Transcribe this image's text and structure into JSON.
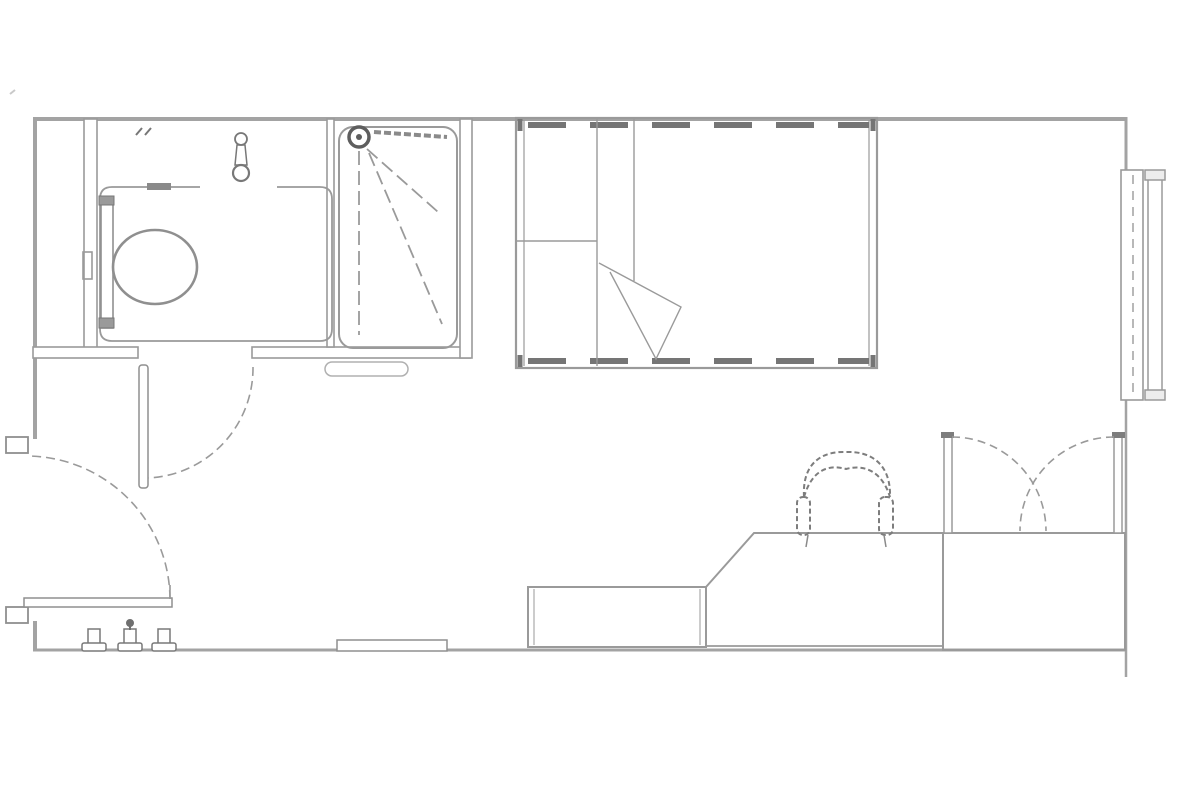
{
  "plan": {
    "type": "floor-plan",
    "background": "#ffffff",
    "colors": {
      "wall": "#a3a3a3",
      "line": "#9a9a9a",
      "detail": "#7d7d7d",
      "dark": "#6f6f6f",
      "light": "#b5b5b5"
    },
    "rooms": [
      {
        "name": "bathroom",
        "fixtures": [
          "toilet",
          "toilet-cistern",
          "wash-basin-tap",
          "vanity-counter",
          "wet-room-floor",
          "shower-tray",
          "shower-head",
          "shower-grab-bar",
          "shower-spray",
          "bathroom-door",
          "threshold"
        ]
      },
      {
        "name": "bedroom",
        "fixtures": [
          "single-bed",
          "pillow-divider",
          "folded-duvet",
          "desk",
          "desk-return-unit",
          "desk-chair",
          "wardrobe",
          "wardrobe-doors",
          "window",
          "radiator",
          "entrance-door",
          "wall-hooks",
          "skirting-vent"
        ]
      }
    ]
  }
}
